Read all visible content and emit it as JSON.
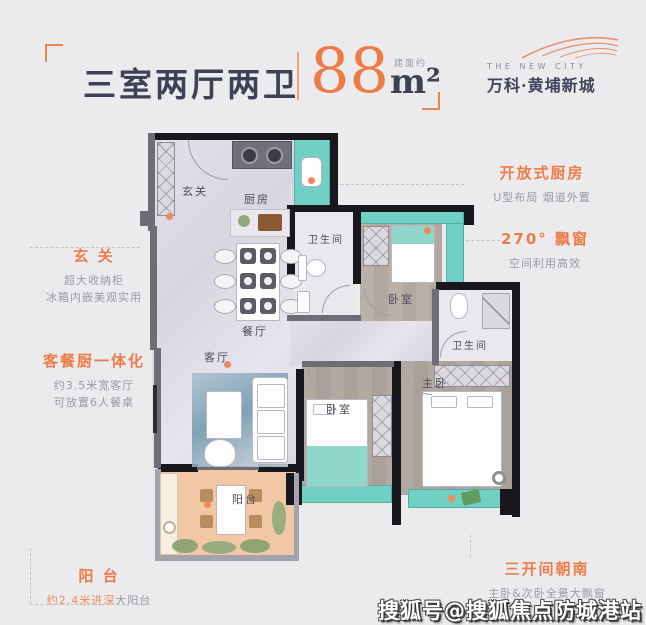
{
  "header": {
    "title": "三室两厅两卫",
    "area_value": "88",
    "area_unit": "m²",
    "area_prefix": "建面约",
    "brand_en": "THE NEW CITY",
    "brand_cn": "万科·黄埔新城"
  },
  "accent_color": "#ee7c48",
  "annotations": {
    "left": [
      {
        "title": "玄 关",
        "lines": [
          "超大收纳柜",
          "冰箱内嵌美观实用"
        ]
      },
      {
        "title": "客餐厨一体化",
        "lines": [
          "约3.5米宽客厅",
          "可放置6人餐桌"
        ]
      },
      {
        "title": "阳 台",
        "line_accent": "约2.4米进深",
        "line_gray": "大阳台"
      }
    ],
    "right": [
      {
        "title": "开放式厨房",
        "lines": [
          "U型布局 烟道外置"
        ]
      },
      {
        "title": "270° 飘窗",
        "lines": [
          "空间利用高效"
        ]
      },
      {
        "title": "三开间朝南",
        "lines": [
          "主卧&次卧全景大飘窗"
        ]
      }
    ]
  },
  "rooms": {
    "entry": "玄关",
    "kitchen": "厨房",
    "bath1": "卫生间",
    "bed_top": "卧室",
    "dining": "餐厅",
    "living": "客厅",
    "bath2": "卫生间",
    "master": "主卧",
    "bed2": "卧室",
    "balcony": "阳台"
  },
  "watermark": "搜狐号@搜狐焦点防城港站"
}
